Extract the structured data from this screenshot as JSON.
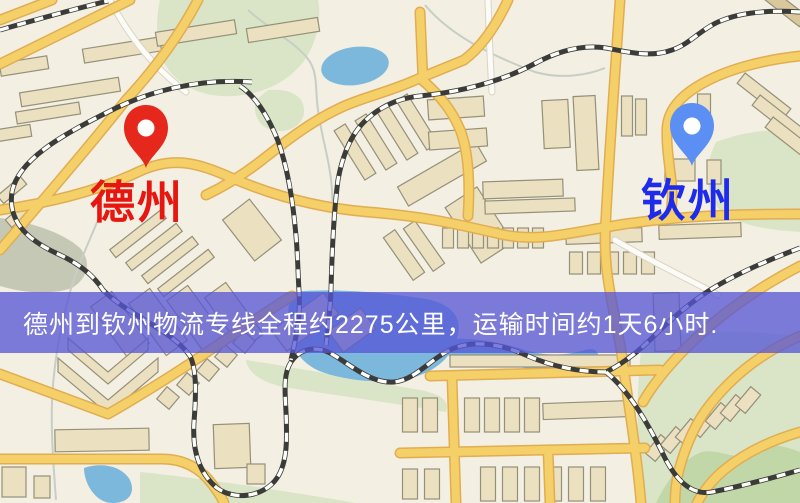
{
  "origin": {
    "name": "德州",
    "pin_color": "#E5281B",
    "label_color": "#E81610"
  },
  "destination": {
    "name": "钦州",
    "pin_color": "#5B8FF3",
    "label_color": "#1F2BEA"
  },
  "banner": {
    "text": "德州到钦州物流专线全程约2275公里，运输时间约1天6小时.",
    "background": "#5656D6",
    "text_color": "#FFFFFF"
  },
  "map_colors": {
    "background": "#F3EFE2",
    "road_major": "#F5D069",
    "road_minor": "#FCFBF5",
    "water": "#7CB8DC",
    "park": "#D9E5C6",
    "building": "#EBE0C0",
    "railway": "#3B3B39"
  }
}
